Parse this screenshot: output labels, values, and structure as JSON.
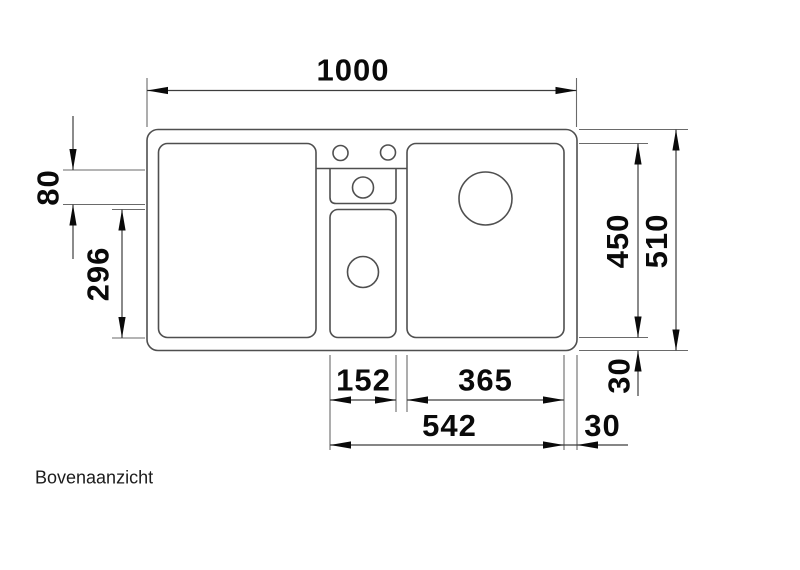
{
  "drawing": {
    "caption": "Bovenaanzicht",
    "view": "top-view-technical-drawing",
    "dimensions": {
      "overall_width": "1000",
      "ledge_depth": "80",
      "lower_middle_bowl_length": "296",
      "inner_bowl_depth": "450",
      "overall_depth": "510",
      "rim_bottom_vertical": "30",
      "middle_bowl_width": "152",
      "main_bowl_width": "365",
      "bowls_overall_width": "542",
      "rim_right_horizontal": "30"
    }
  },
  "colors": {
    "background": "#ffffff",
    "line": "#4f4f4f",
    "dimension": "#3d3d3d",
    "text": "#0a0a0a"
  }
}
